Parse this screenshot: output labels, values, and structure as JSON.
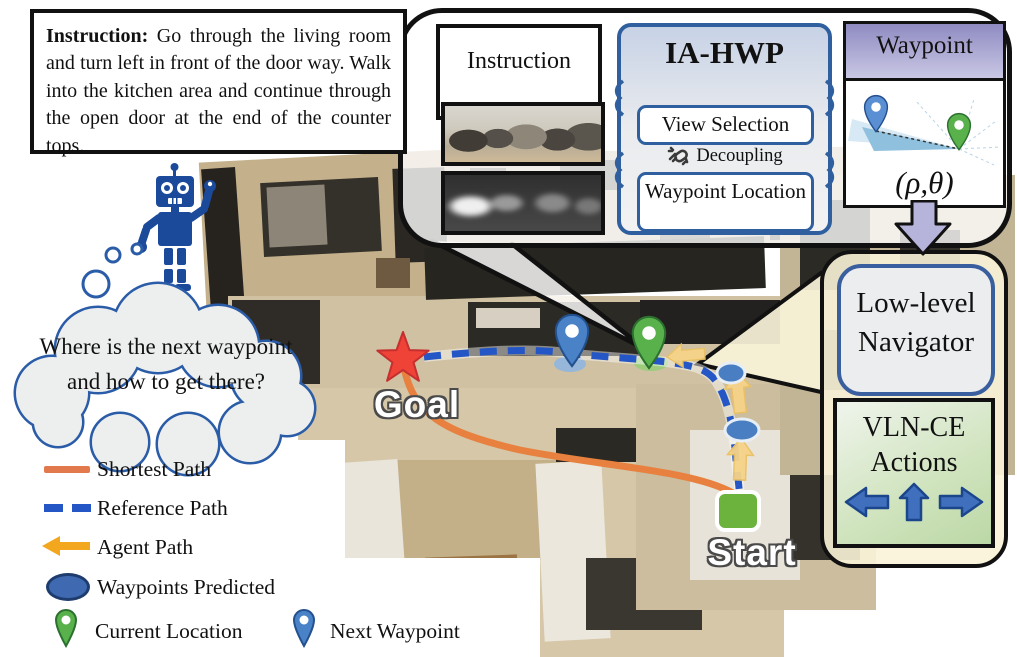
{
  "instruction_box": {
    "lead": "Instruction:",
    "body": "Go through the living room and turn left in front of the door way. Walk into the kitchen area and continue through the open door at the end of the counter tops."
  },
  "robot": {
    "thought": "Where is the next waypoint and how to get there?"
  },
  "pipeline": {
    "instruction_panel": {
      "title": "Instruction"
    },
    "ia_hwp": {
      "title": "IA-HWP",
      "view_selection": "View Selection",
      "decoupling": "Decoupling",
      "waypoint_location": "Waypoint Location"
    },
    "waypoint_panel": {
      "title": "Waypoint",
      "coords": "(ρ,θ)"
    },
    "low_level_navigator": "Low-level Navigator",
    "vln_ce_actions": "VLN-CE Actions"
  },
  "map": {
    "goal_label": "Goal",
    "start_label": "Start"
  },
  "legend": {
    "items": [
      {
        "label": "Shortest Path",
        "swatch": "orange-line"
      },
      {
        "label": "Reference Path",
        "swatch": "blue-dashed-line"
      },
      {
        "label": "Agent Path",
        "swatch": "yellow-left-arrow"
      },
      {
        "label": "Waypoints Predicted",
        "swatch": "blue-ellipse"
      },
      {
        "label": "Current Location",
        "swatch": "green-pin"
      },
      {
        "label": "Next Waypoint",
        "swatch": "blue-pin"
      }
    ]
  },
  "icons": {
    "robot": "robot-icon",
    "thought_bubble": "thought-bubble-icon",
    "broken_chain": "broken-chain-icon",
    "goal_star": "goal-star-icon",
    "start_square": "start-square-icon",
    "green_pin": "current-location-pin-icon",
    "blue_pin": "next-waypoint-pin-icon",
    "down_arrow": "down-block-arrow-icon",
    "action_arrows": [
      "left-arrow-icon",
      "up-arrow-icon",
      "right-arrow-icon"
    ]
  },
  "colors": {
    "robot_blue": "#1b4a9b",
    "shortest_path_orange": "#e8813f",
    "reference_path_blue": "#2456c6",
    "agent_path_yellow": "#f3cd82",
    "goal_red": "#ef4338",
    "start_green": "#6cb33e",
    "waypoint_header_purple": "#a4a0ce",
    "callout_cream": "#f8f2d6",
    "panel_border_blue": "#2f5f9e",
    "actions_green": "#cfe3bd",
    "down_arrow_lavender": "#b7b4db"
  }
}
